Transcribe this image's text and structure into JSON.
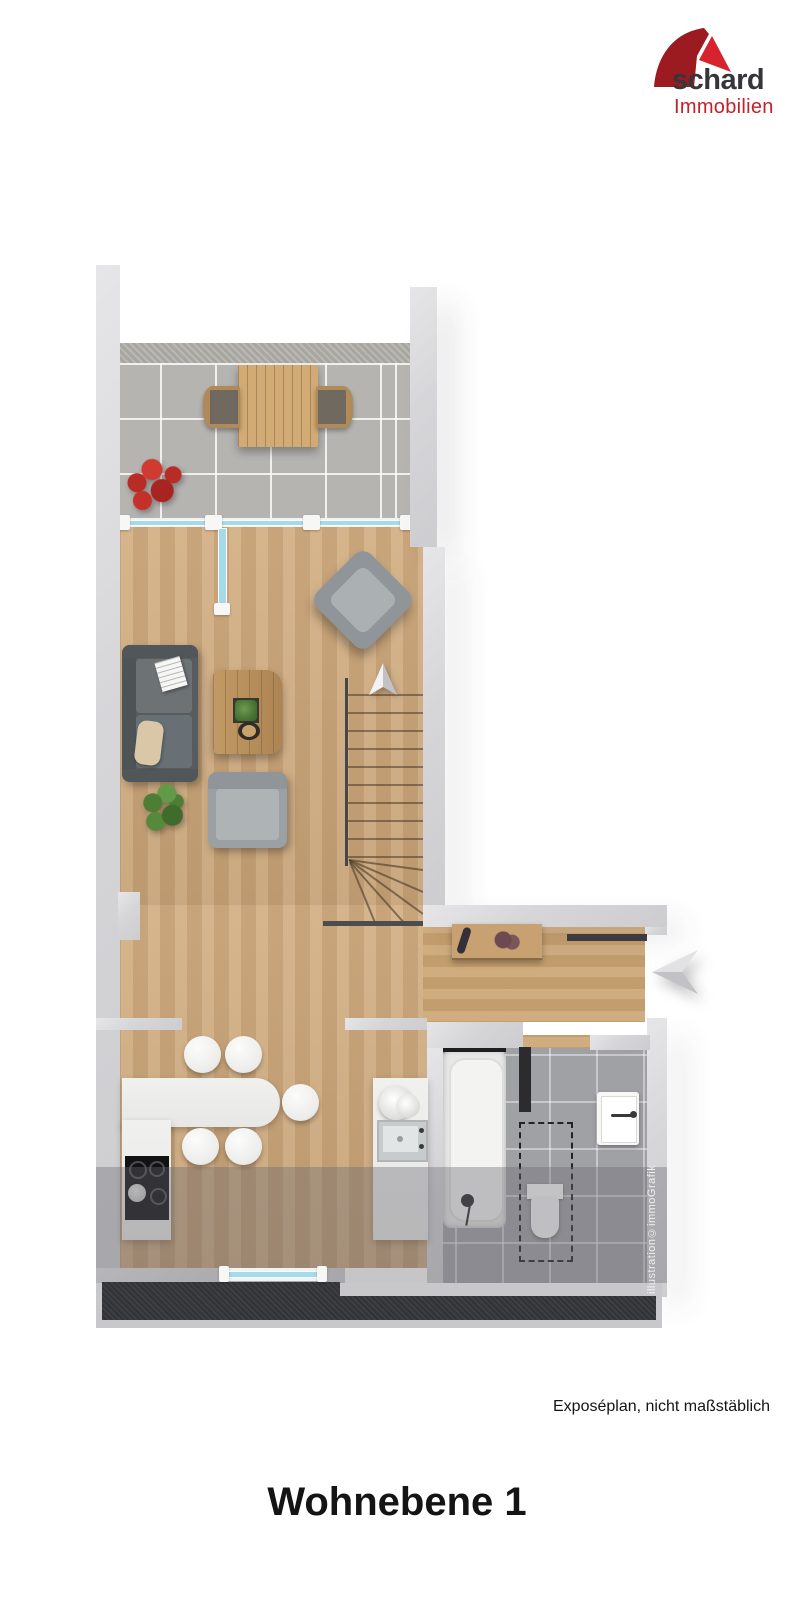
{
  "logo": {
    "brand": "schard",
    "subtitle": "Immobilien",
    "colors": {
      "dome_dark": "#9b1b21",
      "dome_light": "#d7232d",
      "brand_text": "#35353a",
      "subtitle_text": "#c4202a"
    }
  },
  "floorplan": {
    "watermark": "illustration©immoGrafik",
    "palette": {
      "wall": "#d5d5d7",
      "wood_floor": "#cfa97c",
      "balcony_tile": "#b5b4b1",
      "bathroom_tile": "#a0a1a5",
      "glass": "#a5dbe8",
      "sofa": "#575c5f",
      "armchair": "#9aa0a3",
      "kitchen_counter": "#ececea",
      "terrace_dark": "#34363a"
    }
  },
  "footer": {
    "note": "Exposéplan, nicht maßstäblich",
    "title": "Wohnebene 1"
  }
}
